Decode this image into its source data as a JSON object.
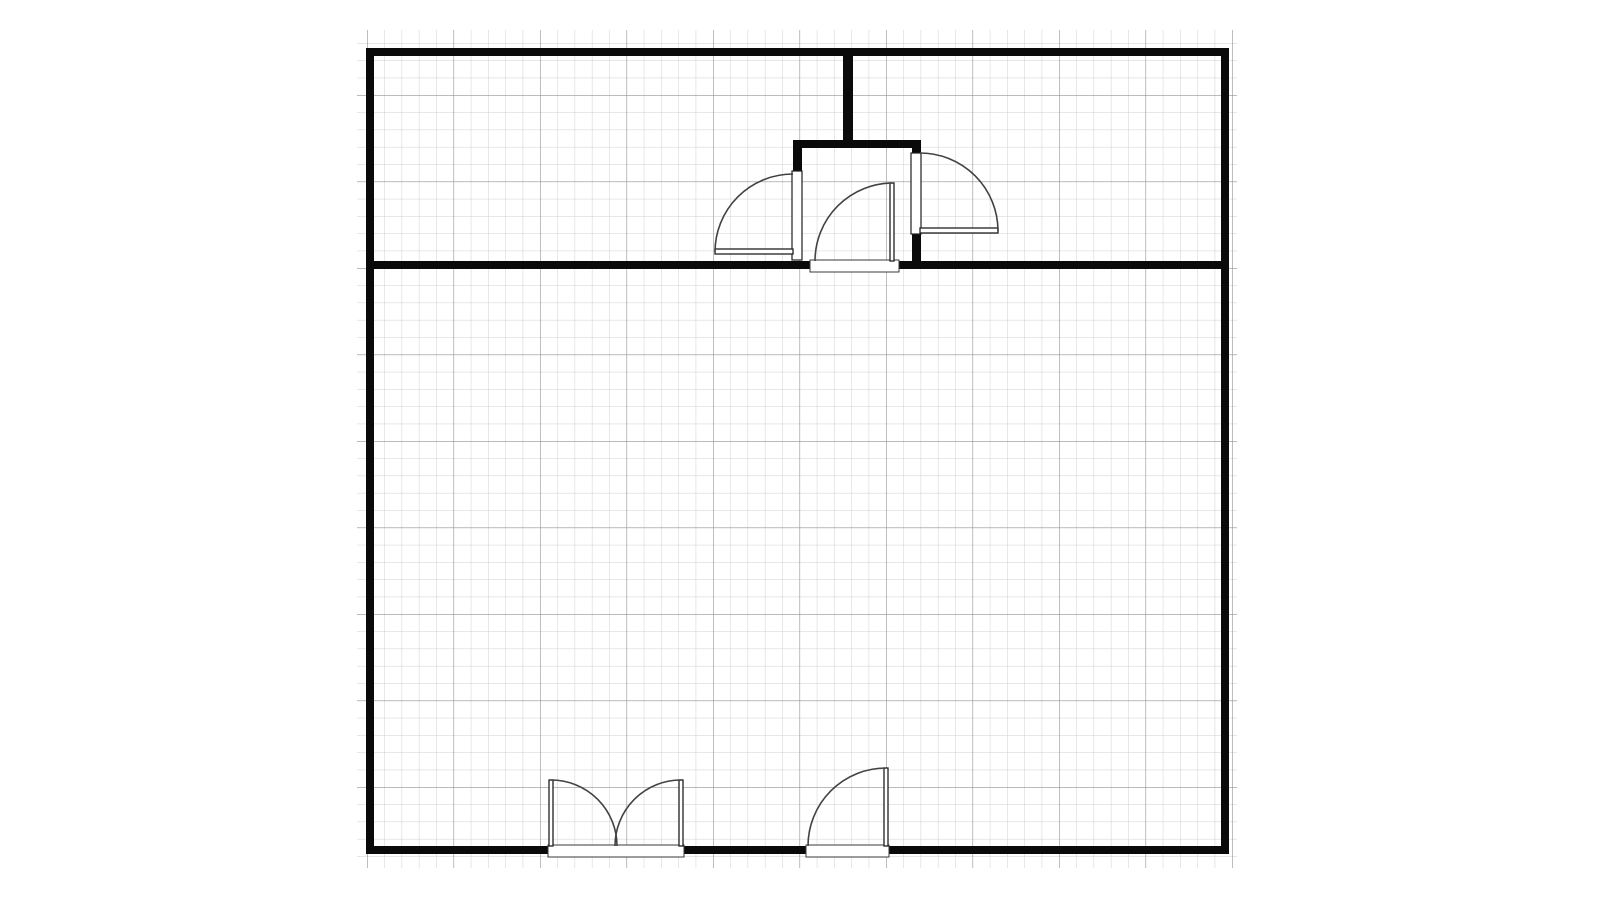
{
  "drawing": {
    "type": "floor-plan",
    "canvas": {
      "width": 1600,
      "height": 900,
      "background": "#ffffff"
    },
    "colors": {
      "wall_fill": "#0a0a0a",
      "door_line": "#424242",
      "leaf_fill": "#ffffff",
      "threshold_fill": "#ffffff",
      "threshold_stroke": "#3a3a3a",
      "jamb_stroke": "#1f1f1f",
      "grid_minor": "#cfcfcf",
      "grid_major": "#929292"
    },
    "grid": {
      "x": 357,
      "y": 30,
      "width": 880,
      "height": 838,
      "minor_spacing": 17.3,
      "major_spacing": 86.5,
      "origin_x": 367,
      "origin_y": 268,
      "minor_stroke_width": 1,
      "major_stroke_width": 1.2
    },
    "walls": [
      {
        "name": "outer-wall-top",
        "x": 366,
        "y": 48,
        "w": 863,
        "h": 8
      },
      {
        "name": "outer-wall-left",
        "x": 366,
        "y": 48,
        "w": 8,
        "h": 806
      },
      {
        "name": "outer-wall-right",
        "x": 1221,
        "y": 48,
        "w": 8,
        "h": 806
      },
      {
        "name": "outer-wall-bottom-left",
        "x": 366,
        "y": 846,
        "w": 183,
        "h": 8
      },
      {
        "name": "outer-wall-bottom-mid",
        "x": 683,
        "y": 846,
        "w": 124,
        "h": 8
      },
      {
        "name": "outer-wall-bottom-right",
        "x": 888,
        "y": 846,
        "w": 341,
        "h": 8
      },
      {
        "name": "divider-wall-left",
        "x": 366,
        "y": 261,
        "w": 445,
        "h": 8
      },
      {
        "name": "divider-wall-right",
        "x": 898,
        "y": 261,
        "w": 331,
        "h": 8
      },
      {
        "name": "top-partition-stub",
        "x": 843,
        "y": 50,
        "w": 10,
        "h": 95
      },
      {
        "name": "vestibule-top-wall",
        "x": 793,
        "y": 140,
        "w": 128,
        "h": 8
      },
      {
        "name": "vestibule-left-stub",
        "x": 793,
        "y": 140,
        "w": 9,
        "h": 31
      },
      {
        "name": "vestibule-right-stub-upper",
        "x": 912,
        "y": 140,
        "w": 9,
        "h": 13
      },
      {
        "name": "vestibule-right-wall-lower",
        "x": 912,
        "y": 234,
        "w": 9,
        "h": 35
      }
    ],
    "door_openings": [
      {
        "name": "vestibule-left-door-opening",
        "x": 792,
        "y": 171,
        "w": 10,
        "h": 89
      },
      {
        "name": "vestibule-right-door-opening",
        "x": 911,
        "y": 153,
        "w": 10,
        "h": 81
      }
    ],
    "thresholds": [
      {
        "name": "vestibule-bottom-threshold",
        "x": 810,
        "y": 260,
        "w": 89,
        "h": 12
      },
      {
        "name": "double-door-threshold",
        "x": 548,
        "y": 845,
        "w": 136,
        "h": 12
      },
      {
        "name": "single-door-threshold",
        "x": 806,
        "y": 845,
        "w": 83,
        "h": 12
      }
    ],
    "door_leaves": [
      {
        "name": "vestibule-left-door-leaf",
        "x": 715,
        "y": 249,
        "w": 78,
        "h": 5
      },
      {
        "name": "vestibule-right-door-leaf",
        "x": 920,
        "y": 228,
        "w": 78,
        "h": 5
      },
      {
        "name": "vestibule-center-door-leaf",
        "x": 890,
        "y": 183,
        "w": 4,
        "h": 78
      },
      {
        "name": "double-door-left-leaf",
        "x": 549,
        "y": 780,
        "w": 4,
        "h": 66
      },
      {
        "name": "double-door-right-leaf",
        "x": 679,
        "y": 780,
        "w": 4,
        "h": 66
      },
      {
        "name": "single-door-leaf",
        "x": 884,
        "y": 768,
        "w": 4,
        "h": 78
      }
    ],
    "door_arcs": [
      {
        "name": "vestibule-left-door-arc",
        "path": "M 793 174 A 78 78 0 0 0 715 252"
      },
      {
        "name": "vestibule-right-door-arc",
        "path": "M 920 153 A 78 78 0 0 1 998 231"
      },
      {
        "name": "vestibule-center-door-arc",
        "path": "M 893 183 A 78 78 0 0 0 815 261"
      },
      {
        "name": "double-door-left-arc",
        "path": "M 551 780 A 66 66 0 0 1 617 846"
      },
      {
        "name": "double-door-right-arc",
        "path": "M 681 780 A 66 66 0 0 0 615 846"
      },
      {
        "name": "single-door-arc",
        "path": "M 886 768 A 78 78 0 0 0 808 846"
      }
    ]
  }
}
